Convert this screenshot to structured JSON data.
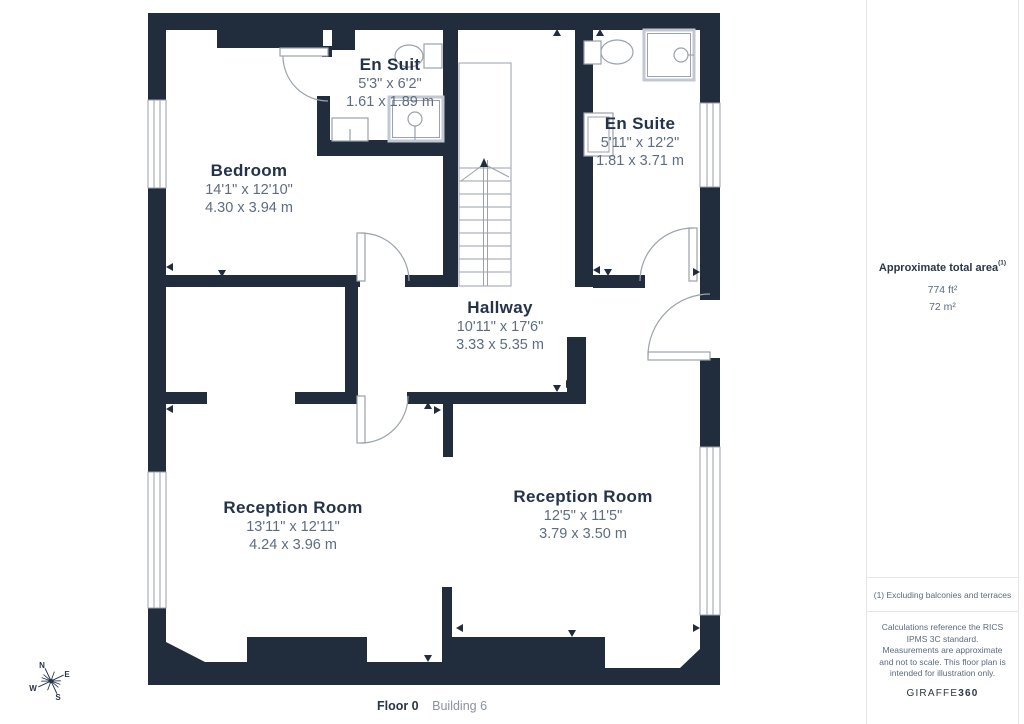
{
  "plan": {
    "rooms": [
      {
        "name": "Bedroom",
        "dims_ft": "14'1\" x 12'10\"",
        "dims_m": "4.30 x 3.94 m"
      },
      {
        "name": "En Suit",
        "dims_ft": "5'3\" x 6'2\"",
        "dims_m": "1.61 x 1.89 m"
      },
      {
        "name": "En Suite",
        "dims_ft": "5'11\" x 12'2\"",
        "dims_m": "1.81 x 3.71 m"
      },
      {
        "name": "Hallway",
        "dims_ft": "10'11\" x 17'6\"",
        "dims_m": "3.33 x 5.35 m"
      },
      {
        "name": "Reception Room",
        "dims_ft": "13'11\" x 12'11\"",
        "dims_m": "4.24 x 3.96 m"
      },
      {
        "name": "Reception Room",
        "dims_ft": "12'5\" x 11'5\"",
        "dims_m": "3.79 x 3.50 m"
      }
    ]
  },
  "sidebar": {
    "area_title": "Approximate total area",
    "area_superscript": "(1)",
    "area_ft": "774 ft²",
    "area_m": "72 m²",
    "note": "(1) Excluding balconies and terraces",
    "disclaimer": "Calculations reference the RICS IPMS 3C standard. Measurements are approximate and not to scale. This floor plan is intended for illustration only.",
    "brand_name": "GIRAFFE",
    "brand_suffix": "360"
  },
  "footer": {
    "floor": "Floor 0",
    "building": "Building 6"
  },
  "compass": {
    "n": "N",
    "e": "E",
    "s": "S",
    "w": "W"
  },
  "colors": {
    "wall": "#212C3D",
    "room_name": "#24334A",
    "dim_text": "#5D6D82",
    "thin_line": "#9AA2AD"
  }
}
